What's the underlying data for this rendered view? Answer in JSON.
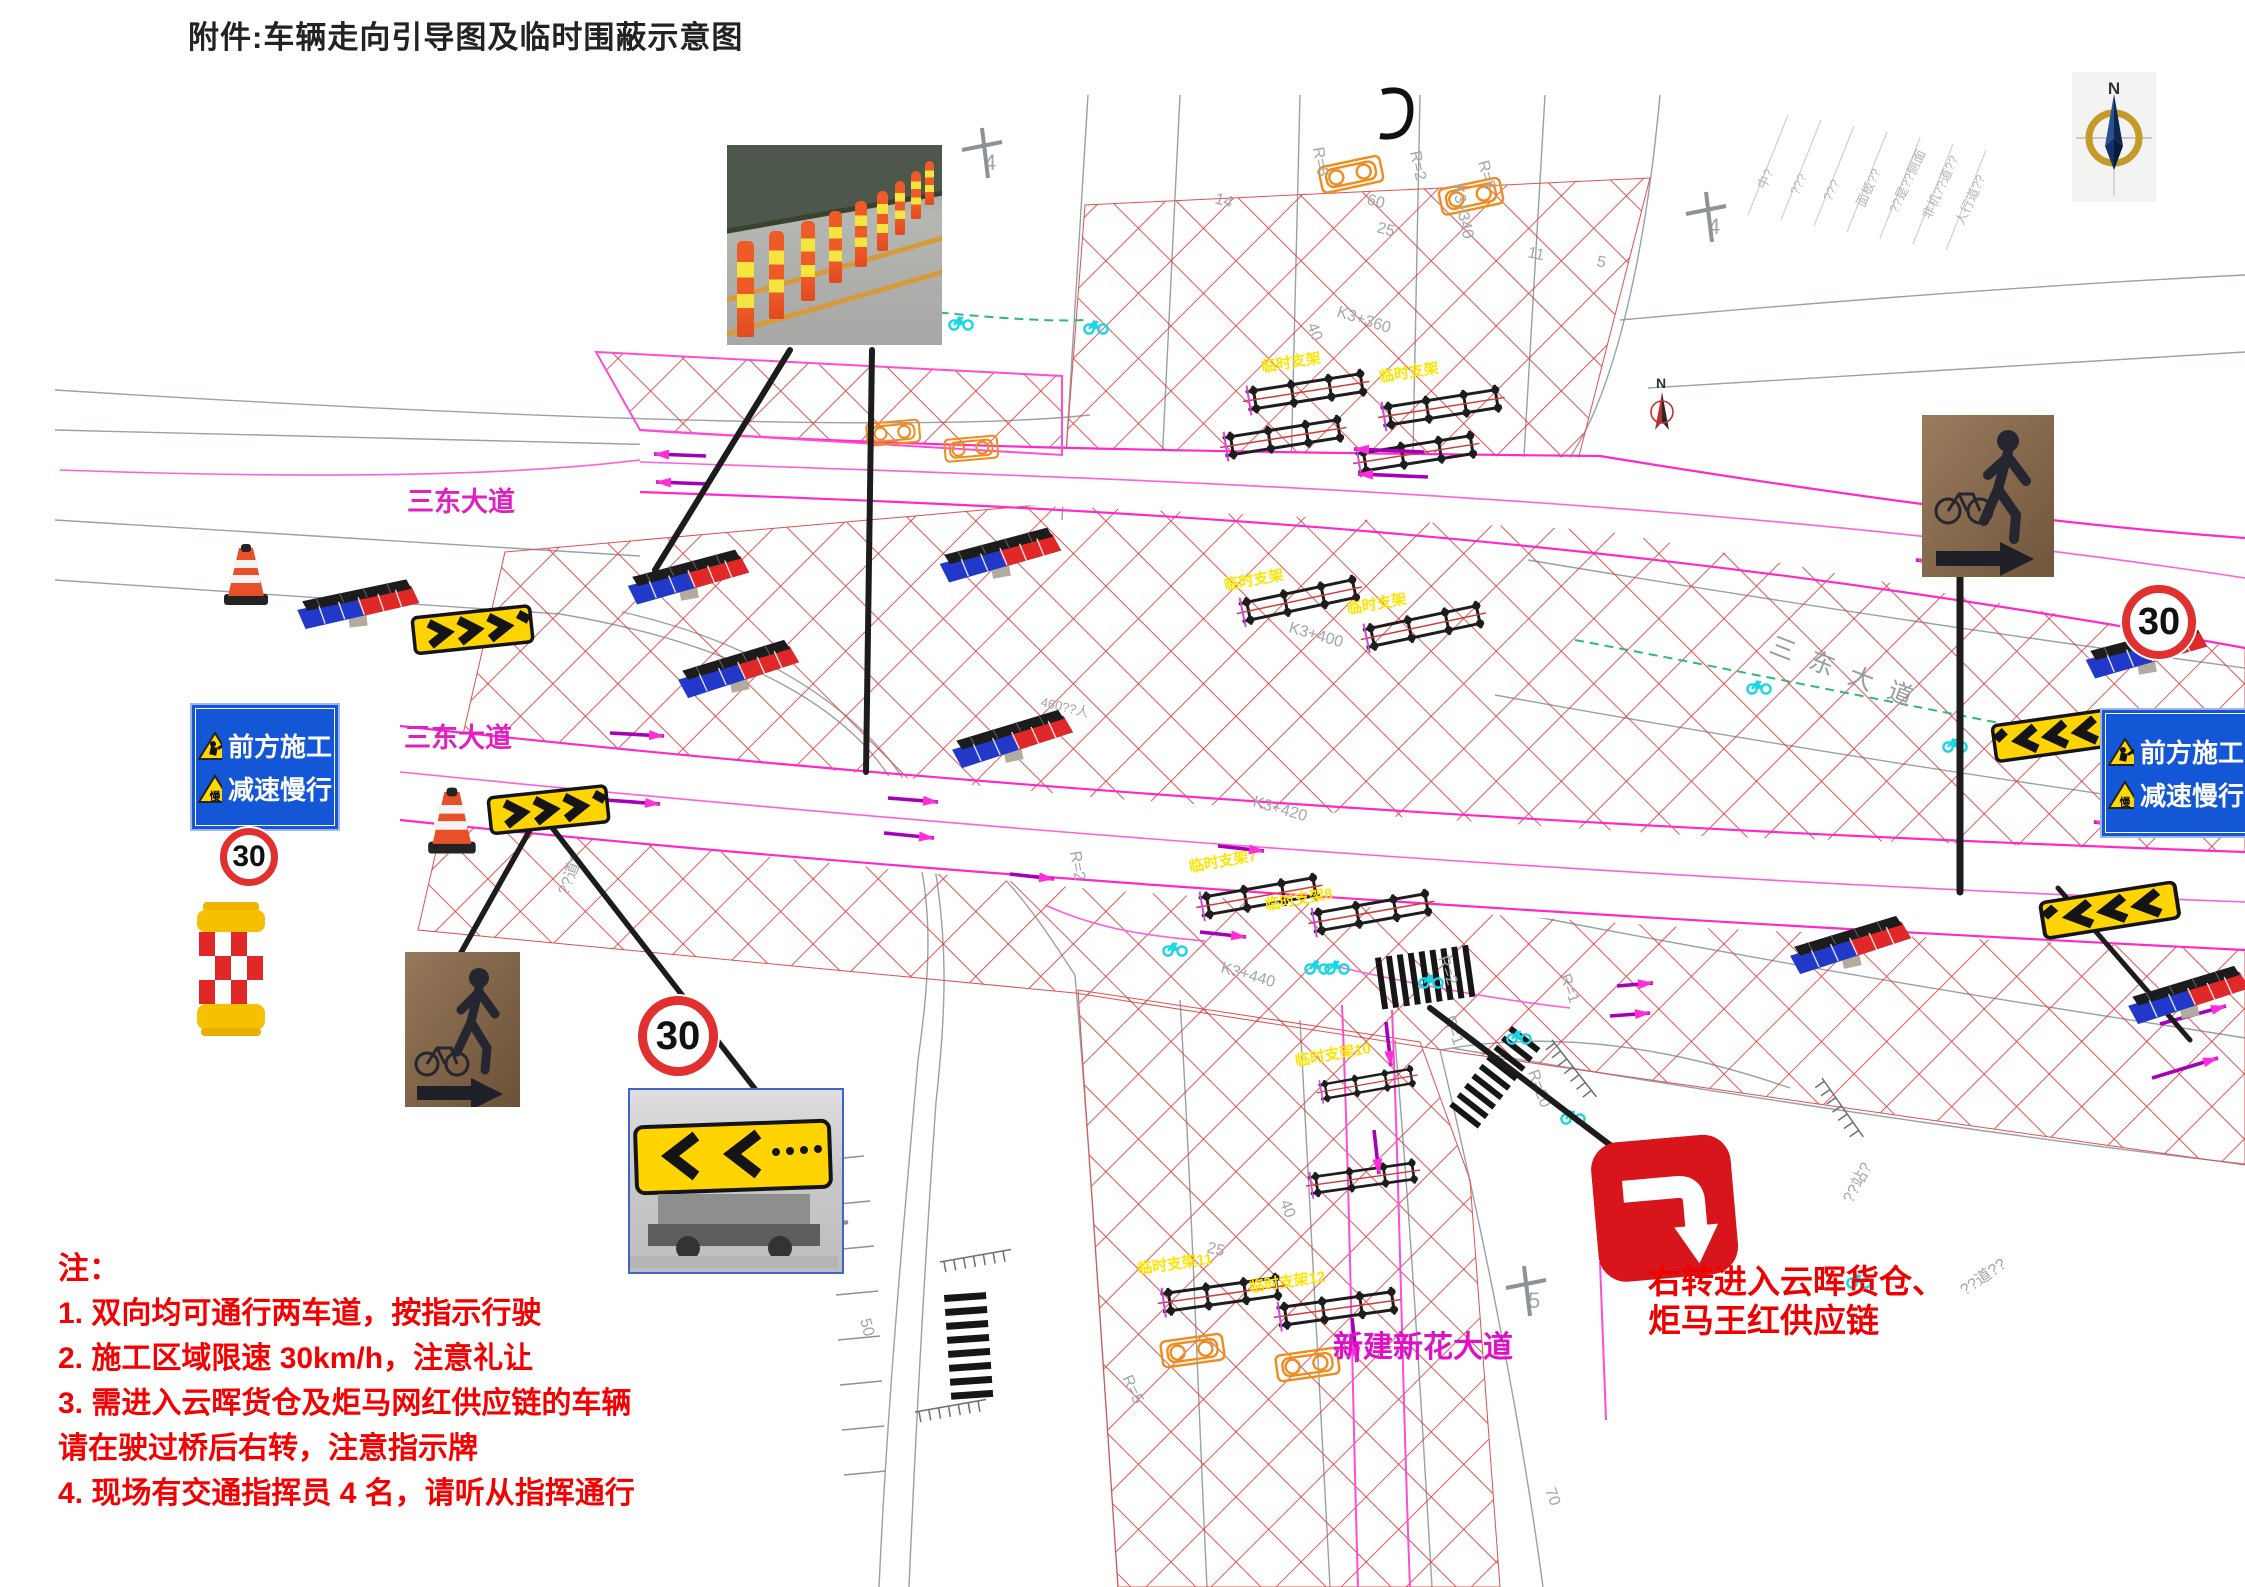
{
  "page": {
    "title": "附件:车辆走向引导图及临时围蔽示意图"
  },
  "roads": {
    "sandong_upper": "三东大道",
    "sandong_lower": "三东大道",
    "sandong_right": "三东大道",
    "xinhua": "新建新花大道"
  },
  "signs": {
    "construction_ahead": "前方施工",
    "slow_down": "减速慢行",
    "slow_icon_char": "慢",
    "speed_limit": "30",
    "right_turn_line1": "右转进入云晖货仓、",
    "right_turn_line2": "炬马王红供应链"
  },
  "notes": {
    "heading": "注：",
    "item1": "1.  双向均可通行两车道，按指示行驶",
    "item2": "2.  施工区域限速 30km/h，注意礼让",
    "item3": "3.  需进入云晖货仓及炬马网红供应链的车辆",
    "item3b": "请在驶过桥后右转，注意指示牌",
    "item4": "4.  现场有交通指挥员 4 名，请听从指挥通行"
  },
  "barriers": {
    "labels": [
      "临时支架",
      "临时支架",
      "临时支架7",
      "临时支架8",
      "临时支架10",
      "临时支架11",
      "临时支架12",
      "临时支架",
      "临时支架"
    ]
  },
  "cad": {
    "labels": [
      "K3+340",
      "R=5",
      "R=2",
      "R=5",
      "K3+360",
      "40",
      "25",
      "14",
      "11",
      "5",
      "K3+400",
      "K3+420",
      "K3+440",
      "R=2",
      "R=2",
      "R=1",
      "R=1",
      "R=20",
      "R=5",
      "50",
      "25",
      "40",
      "70",
      "??站?",
      "??道??",
      "460??人",
      "60",
      "??道?",
      "??大?",
      "4",
      "4",
      "5",
      "5"
    ],
    "legend": [
      "中?",
      "???",
      "???",
      "面板??",
      "??是??侧面",
      "非机??道??",
      "人行道??"
    ]
  },
  "compass": {
    "n": "N",
    "n_small": "N"
  }
}
